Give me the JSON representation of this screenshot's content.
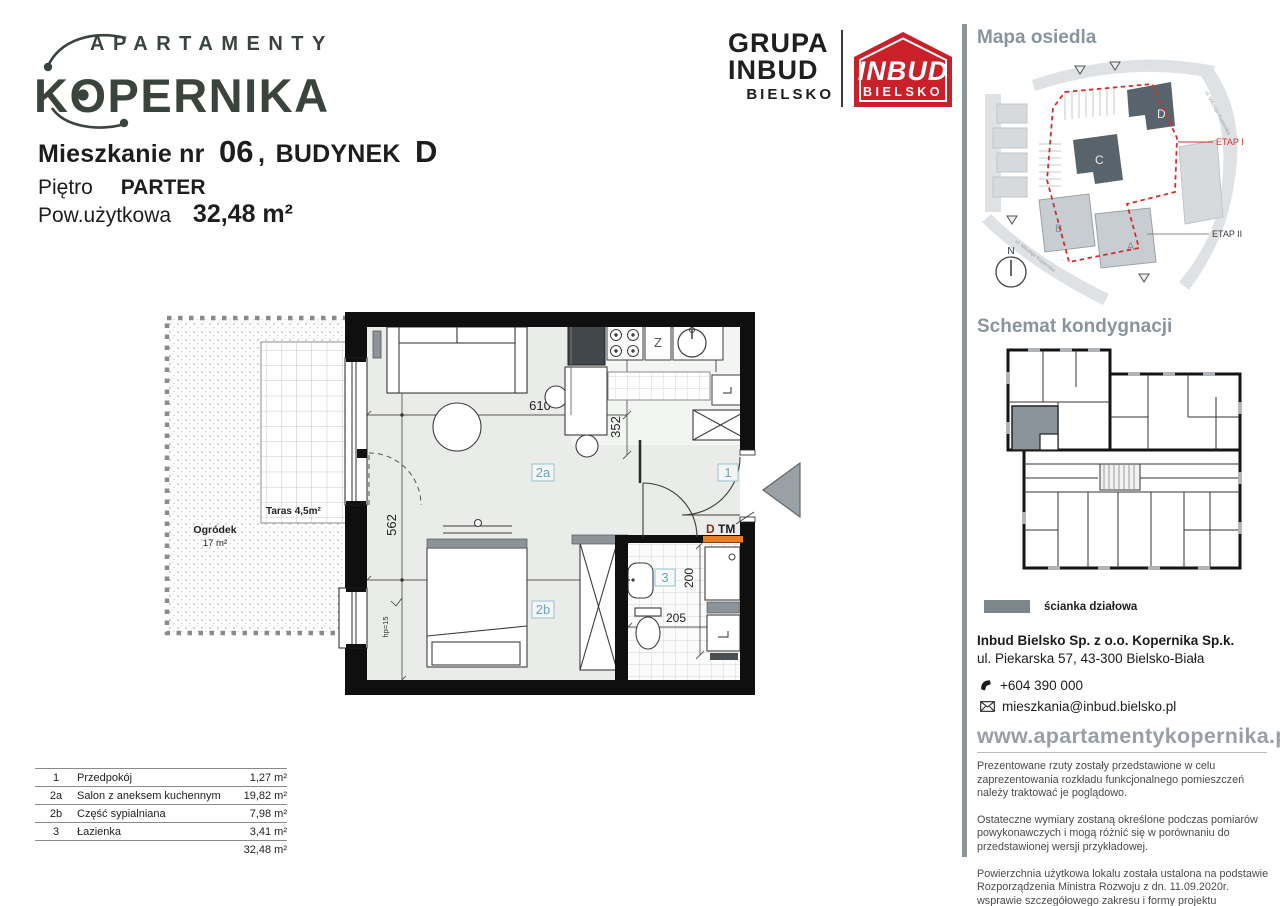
{
  "header": {
    "logo_top": "APARTAMENTY",
    "logo_main": "KOPERNIKA",
    "apt_label": "Mieszkanie nr",
    "apt_no": "06",
    "comma": ",",
    "building_label": "BUDYNEK",
    "building_no": "D",
    "floor_label": "Piętro",
    "floor_value": "PARTER",
    "area_label": "Pow.użytkowa",
    "area_value": "32,48 m²"
  },
  "logos": {
    "grupa1": "GRUPA",
    "grupa2": "INBUD",
    "grupa3": "BIELSKO",
    "inbud1": "INBUD",
    "inbud2": "BIELSKO"
  },
  "plan": {
    "terrace_label": "Taras 4,5m²",
    "garden_label": "Ogródek",
    "garden_area": "17 m²",
    "rooms": {
      "hall": "1",
      "salon": "2a",
      "sleep": "2b",
      "bath": "3"
    },
    "dims": {
      "d610": "610",
      "d562": "562",
      "d352": "352",
      "d395": "395",
      "d200": "200",
      "d205": "205"
    },
    "sink_symbol": "Z",
    "hp_label": "hp=15",
    "d_label": "D",
    "tm_label": "TM"
  },
  "area_table": {
    "rows": [
      {
        "no": "1",
        "name": "Przedpokój",
        "area": "1,27 m²"
      },
      {
        "no": "2a",
        "name": "Salon z aneksem kuchennym",
        "area": "19,82 m²"
      },
      {
        "no": "2b",
        "name": "Część sypialniana",
        "area": "7,98 m²"
      },
      {
        "no": "3",
        "name": "Łazienka",
        "area": "3,41 m²"
      }
    ],
    "total": "32,48 m²"
  },
  "sidebar": {
    "map_title": "Mapa osiedla",
    "map": {
      "etap1": "ETAP I",
      "etap2": "ETAP II",
      "north": "N",
      "b_a": "A",
      "b_b": "B",
      "b_c": "C",
      "b_d": "D",
      "street": "ul. Mikołaja Kopernika"
    },
    "schema_title": "Schemat kondygnacji",
    "legend_label": "ścianka działowa",
    "company_name": "Inbud Bielsko Sp. z o.o. Kopernika Sp.k.",
    "company_address": "ul. Piekarska 57,  43-300 Bielsko-Biała",
    "phone": "+604 390 000",
    "email": "mieszkania@inbud.bielsko.pl",
    "website": "www.apartamentykopernika.pl",
    "disclaimers": [
      "Prezentowane rzuty zostały przedstawione w celu zaprezentowania rozkładu funkcjonalnego pomieszczeń należy traktować je poglądowo.",
      "Ostateczne wymiary zostaną określone podczas pomiarów powykonawczych i mogą różnić się w porównaniu do przedstawionej wersji przykładowej.",
      "Powierzchnia użytkowa lokalu została ustalona na podstawie Rozporządzenia Ministra Rozwoju z dn. 11.09.2020r. wsprawie szczegółowego zakresu i formy projektu budowlanego oraz przy uwzględnieniu Polskiej Normy PN-ISO 9836: 2022-07"
    ]
  },
  "colors": {
    "accent_red": "#c9202a",
    "panel_gray": "#8a949d",
    "orange": "#e87e25",
    "wall_black": "#0f0f0f",
    "floor": "#e9ece8",
    "label_blue": "#6fa3bc",
    "logo_dark": "#3a443d"
  }
}
